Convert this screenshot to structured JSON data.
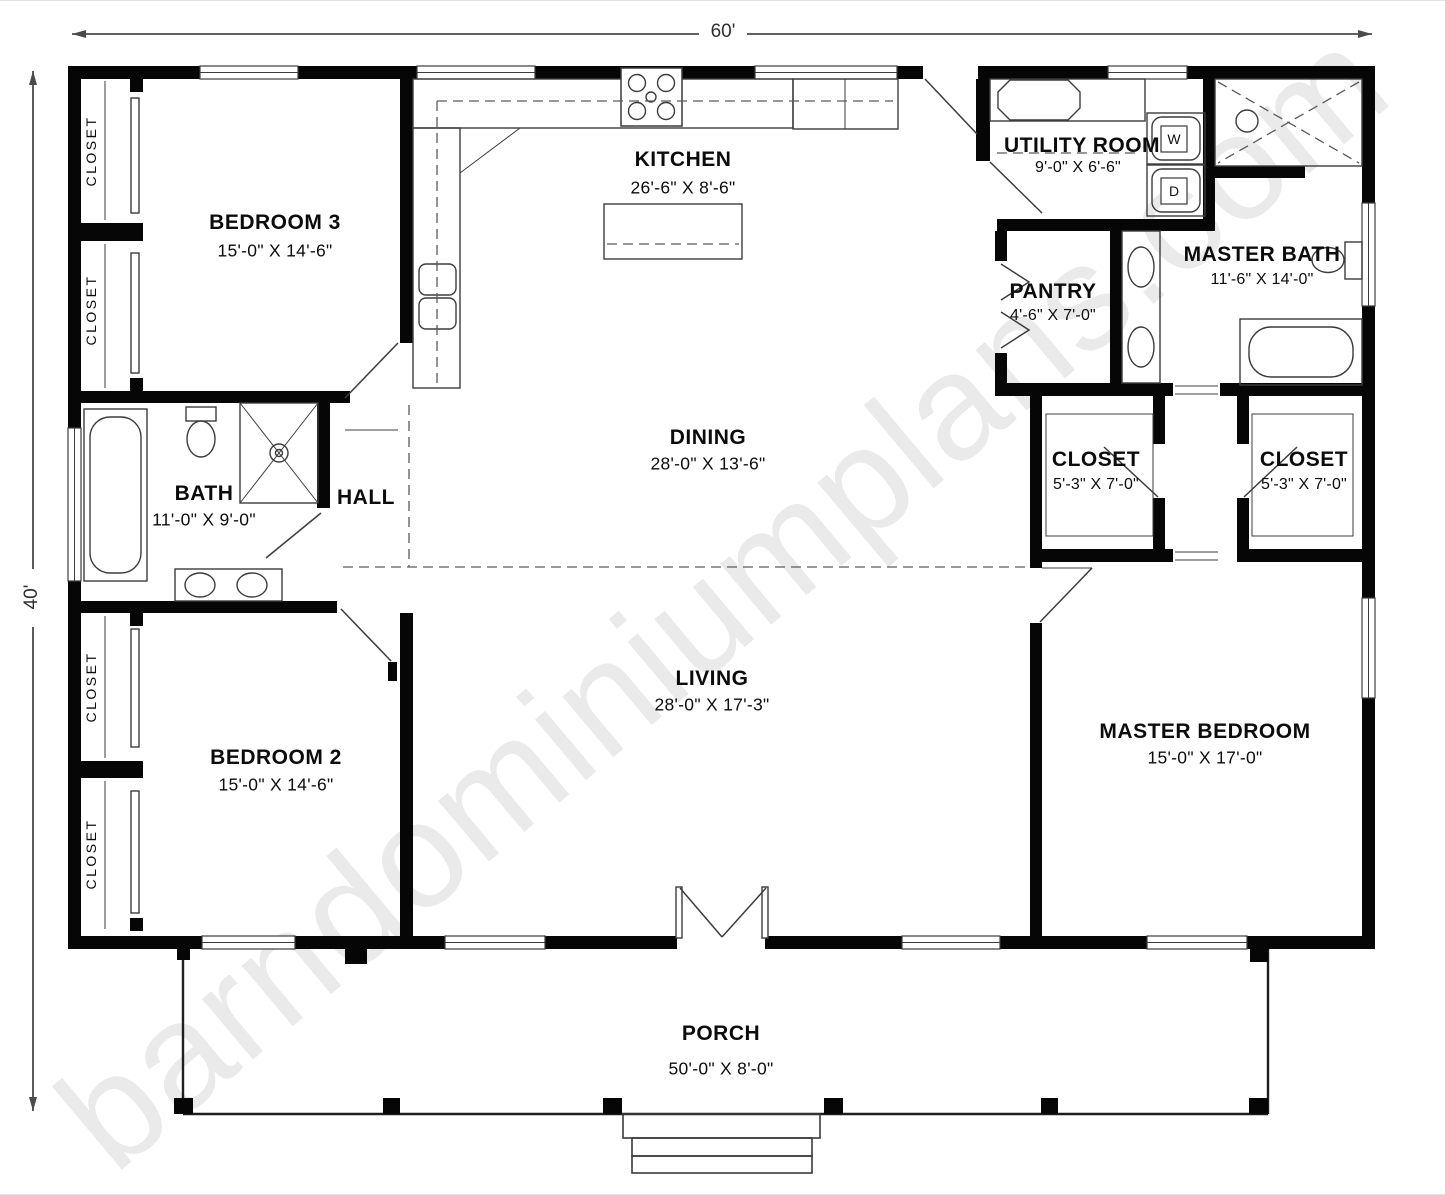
{
  "watermark": {
    "text": "barndominiumplans.com",
    "color": "#eaeaea"
  },
  "dimension_labels": {
    "top": "60'",
    "left": "40'"
  },
  "labels": {
    "closet": "CLOSET"
  },
  "appliance_labels": {
    "washer": "W",
    "dryer": "D"
  },
  "rooms": {
    "bedroom3": {
      "name": "BEDROOM 3",
      "size": "15'-0\" X 14'-6\""
    },
    "kitchen": {
      "name": "KITCHEN",
      "size": "26'-6\" X 8'-6\""
    },
    "utility": {
      "name": "UTILITY ROOM",
      "size": "9'-0\" X 6'-6\""
    },
    "master_bath": {
      "name": "MASTER BATH",
      "size": "11'-6\" X 14'-0\""
    },
    "pantry": {
      "name": "PANTRY",
      "size": "4'-6\" X 7'-0\""
    },
    "dining": {
      "name": "DINING",
      "size": "28'-0\" X 13'-6\""
    },
    "bath": {
      "name": "BATH",
      "size": "11'-0\" X 9'-0\""
    },
    "hall": {
      "name": "HALL"
    },
    "closet1": {
      "name": "CLOSET",
      "size": "5'-3\" X 7'-0\""
    },
    "closet2": {
      "name": "CLOSET",
      "size": "5'-3\" X 7'-0\""
    },
    "bedroom2": {
      "name": "BEDROOM 2",
      "size": "15'-0\" X 14'-6\""
    },
    "living": {
      "name": "LIVING",
      "size": "28'-0\" X 17'-3\""
    },
    "master_bedroom": {
      "name": "MASTER BEDROOM",
      "size": "15'-0\" X 17'-0\""
    },
    "porch": {
      "name": "PORCH",
      "size": "50'-0\" X 8'-0\""
    }
  },
  "colors": {
    "walls": "#060606",
    "thin_line": "#3c3c3c",
    "dashed_line": "#5a5a5a",
    "dimension_line": "#4a4a4a",
    "watermark": "#eaeaea",
    "background": "#ffffff"
  }
}
